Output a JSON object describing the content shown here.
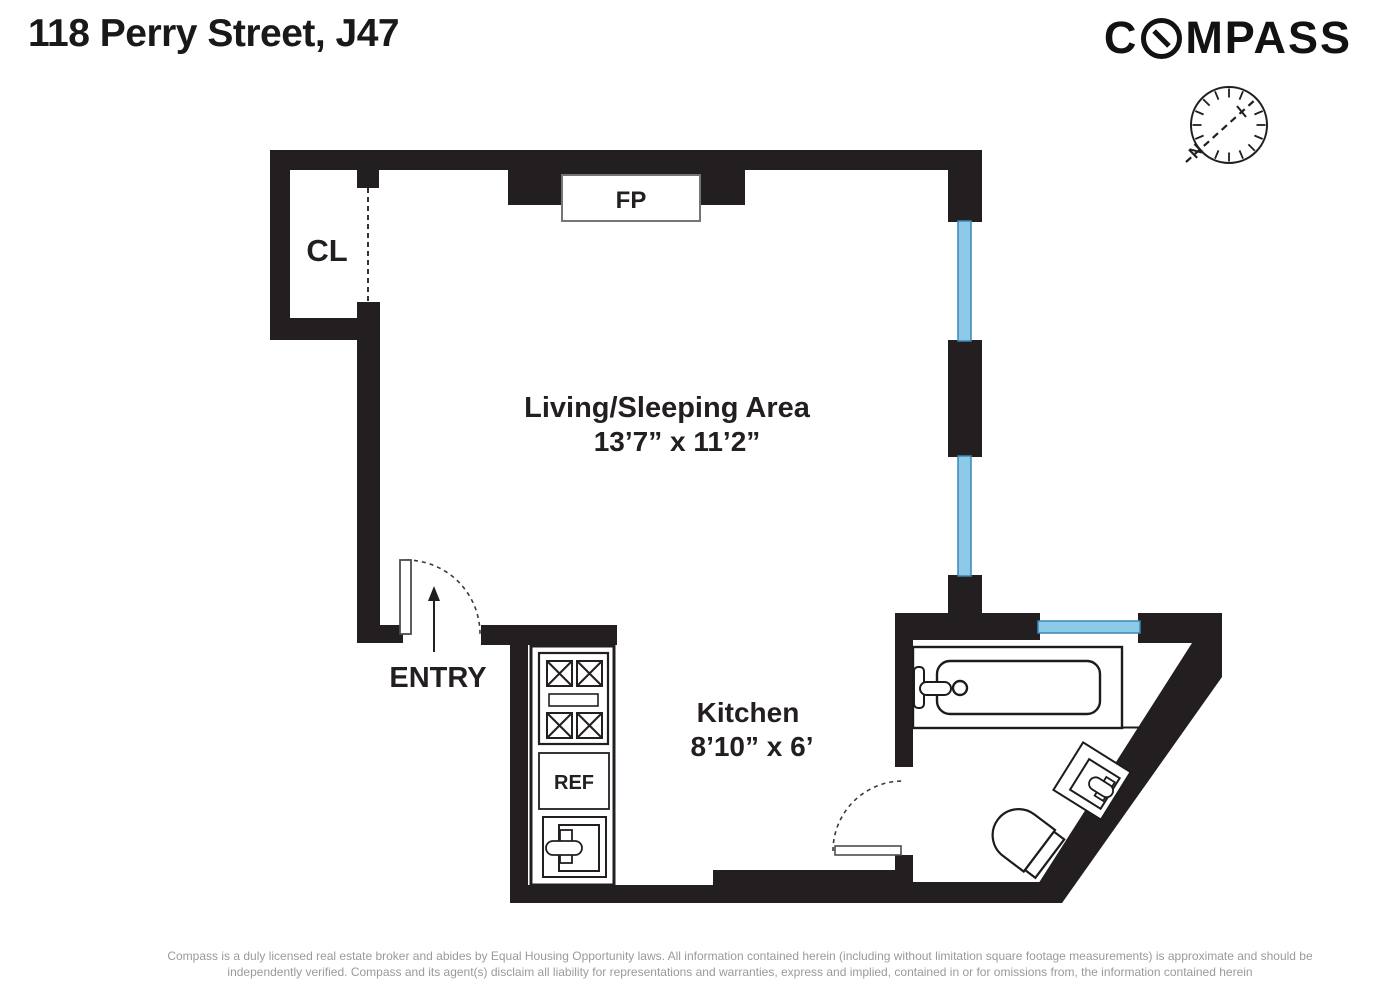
{
  "header": {
    "title": "118 Perry Street, J47"
  },
  "brand": {
    "first": "C",
    "rest": "MPASS"
  },
  "plan": {
    "living_name": "Living/Sleeping Area",
    "living_dims": "13’7” x 11’2”",
    "kitchen_name": "Kitchen",
    "kitchen_dims": "8’10” x 6’",
    "closet": "CL",
    "fireplace": "FP",
    "entry": "ENTRY",
    "fridge": "REF",
    "north": "N",
    "colors": {
      "wall": "#231f20",
      "window_fill": "#8dcae7",
      "window_stroke": "#3c86b7"
    }
  },
  "footer": {
    "line1": "Compass is a duly licensed real estate broker and abides by Equal Housing Opportunity laws.  All information contained herein (including without limitation square footage measurements) is approximate and should be",
    "line2": "independently verified. Compass and its agent(s) disclaim all liability for representations and warranties, express and implied, contained in or for omissions from, the information contained herein"
  }
}
